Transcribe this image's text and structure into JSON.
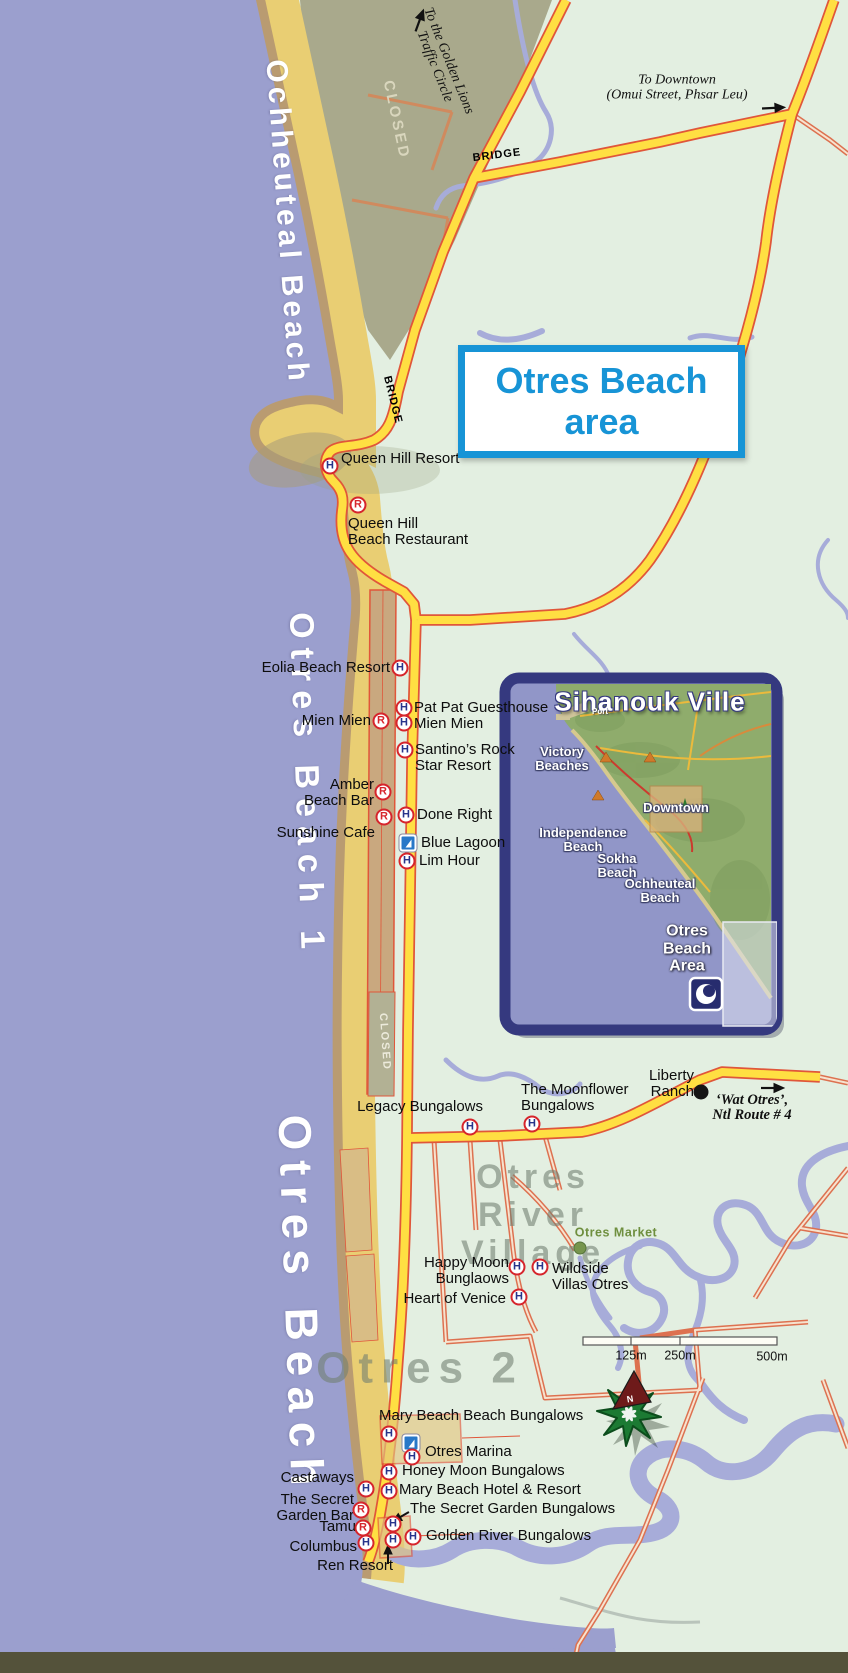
{
  "title_box": {
    "line1": "Otres Beach",
    "line2": "area"
  },
  "compass": {
    "letter": "N"
  },
  "colors": {
    "sea": "#9B9FCE",
    "land": "#E3EFE1",
    "sand": "#E9CE73",
    "wet_sand": "#AC8E70",
    "closed_area": "#A9A98C",
    "road_yellow": "#FFDF42",
    "road_casing": "#E0563A",
    "road_minor": "#DD7150",
    "river": "#A7ACD9",
    "title_blue": "#1794D6",
    "marker_red": "#D6252C",
    "marker_blue": "#27348B",
    "marker_sail_blue": "#2878C8",
    "inset_border": "#35397F",
    "inset_sea": "#9196C8",
    "inset_land": "#8FAC6C",
    "area_label_gray": "#707E70",
    "market_green": "#6F8F3F"
  },
  "map": {
    "labels": [
      {
        "name": "ochheuteal-beach-name",
        "text": "Ochheuteal Beach",
        "x": 287,
        "y": 222,
        "anchor": "middle",
        "cls": "beach-name sz30",
        "rot": 86
      },
      {
        "name": "golden-lions-direction",
        "text": "To the Golden Lions\nTraffic Circle",
        "x": 441,
        "y": 64,
        "anchor": "middle",
        "cls": "dir",
        "rot": 68
      },
      {
        "name": "downtown-direction",
        "text": "To Downtown\n(Omui Street, Phsar Leu)",
        "x": 677,
        "y": 88,
        "anchor": "middle",
        "cls": "dir ta-c"
      },
      {
        "name": "bridge-label-top",
        "text": "BRIDGE",
        "x": 497,
        "y": 156,
        "anchor": "middle",
        "cls": "road-label",
        "rot": -7
      },
      {
        "name": "closed-label-top",
        "text": "CLOSED",
        "x": 396,
        "y": 120,
        "anchor": "middle",
        "cls": "closed-label",
        "rot": 78
      },
      {
        "name": "bridge-label-mid",
        "text": "BRIDGE",
        "x": 392,
        "y": 400,
        "anchor": "middle",
        "cls": "road-label",
        "rot": 76
      },
      {
        "name": "queen-hill-resort-label",
        "text": "Queen Hill Resort",
        "x": 341,
        "y": 451,
        "anchor": "left",
        "cls": "poi"
      },
      {
        "name": "queen-hill-restaurant-label",
        "text": "Queen Hill\nBeach Restaurant",
        "x": 348,
        "y": 516,
        "anchor": "left",
        "cls": "poi"
      },
      {
        "name": "otres-beach-1-name",
        "text": "Otres Beach 1",
        "x": 306,
        "y": 785,
        "anchor": "middle",
        "cls": "beach-name sz34",
        "rot": 88
      },
      {
        "name": "eolia-beach-resort-label",
        "text": "Eolia Beach Resort",
        "x": 390,
        "y": 660,
        "anchor": "right",
        "cls": "poi"
      },
      {
        "name": "pat-pat-guesthouse-label",
        "text": "Pat Pat Guesthouse",
        "x": 414,
        "y": 700,
        "anchor": "left",
        "cls": "poi"
      },
      {
        "name": "mien-mien-label-left",
        "text": "Mien Mien",
        "x": 371,
        "y": 713,
        "anchor": "right",
        "cls": "poi"
      },
      {
        "name": "mien-mien-label-right",
        "text": "Mien Mien",
        "x": 414,
        "y": 716,
        "anchor": "left",
        "cls": "poi"
      },
      {
        "name": "santinos-rock-star-label",
        "text": "Santino’s Rock\nStar Resort",
        "x": 415,
        "y": 742,
        "anchor": "left",
        "cls": "poi"
      },
      {
        "name": "amber-beach-bar-label",
        "text": "Amber\nBeach Bar",
        "x": 374,
        "y": 777,
        "anchor": "right",
        "cls": "poi"
      },
      {
        "name": "done-right-label",
        "text": "Done Right",
        "x": 417,
        "y": 807,
        "anchor": "left",
        "cls": "poi"
      },
      {
        "name": "sunshine-cafe-label",
        "text": "Sunshine Cafe",
        "x": 375,
        "y": 825,
        "anchor": "right",
        "cls": "poi"
      },
      {
        "name": "blue-lagoon-label",
        "text": "Blue Lagoon",
        "x": 421,
        "y": 835,
        "anchor": "left",
        "cls": "poi"
      },
      {
        "name": "lim-hour-label",
        "text": "Lim Hour",
        "x": 419,
        "y": 853,
        "anchor": "left",
        "cls": "poi"
      },
      {
        "name": "legacy-bungalows-label",
        "text": "Legacy Bungalows",
        "x": 483,
        "y": 1099,
        "anchor": "right",
        "cls": "poi"
      },
      {
        "name": "moonflower-bungalows-label",
        "text": "The Moonflower\nBungalows",
        "x": 521,
        "y": 1082,
        "anchor": "left",
        "cls": "poi"
      },
      {
        "name": "liberty-ranch-label",
        "text": "Liberty\nRanch",
        "x": 694,
        "y": 1068,
        "anchor": "right",
        "cls": "poi"
      },
      {
        "name": "wat-otres-direction",
        "text": "‘Wat Otres’,\nNtl Route # 4",
        "x": 752,
        "y": 1108,
        "anchor": "middle",
        "cls": "dir dir-bold ta-c"
      },
      {
        "name": "closed-label-mid",
        "text": "CLOSED",
        "x": 384,
        "y": 1042,
        "anchor": "middle",
        "cls": "closed-label-sm",
        "rot": 86
      },
      {
        "name": "otres-beach-name",
        "text": "Otres Beach",
        "x": 301,
        "y": 1305,
        "anchor": "middle",
        "cls": "beach-name sz40",
        "rot": 88
      },
      {
        "name": "otres-river-village-label",
        "text": "Otres\nRiver\nVillage",
        "x": 533,
        "y": 1215,
        "anchor": "middle",
        "cls": "area-label ta-c"
      },
      {
        "name": "otres-market-label",
        "text": "Otres Market",
        "x": 616,
        "y": 1233,
        "anchor": "middle",
        "cls": "market-label"
      },
      {
        "name": "happy-moon-label",
        "text": "Happy Moon\nBunglaows",
        "x": 509,
        "y": 1255,
        "anchor": "right",
        "cls": "poi"
      },
      {
        "name": "wildside-villas-label",
        "text": "Wildside\nVillas Otres",
        "x": 552,
        "y": 1261,
        "anchor": "left",
        "cls": "poi"
      },
      {
        "name": "heart-of-venice-label",
        "text": "Heart of Venice",
        "x": 506,
        "y": 1291,
        "anchor": "right",
        "cls": "poi"
      },
      {
        "name": "scale-label-125",
        "text": "125m",
        "x": 631,
        "y": 1356,
        "anchor": "middle",
        "cls": "scale-label"
      },
      {
        "name": "scale-label-250",
        "text": "250m",
        "x": 680,
        "y": 1356,
        "anchor": "middle",
        "cls": "scale-label"
      },
      {
        "name": "scale-label-500",
        "text": "500m",
        "x": 772,
        "y": 1357,
        "anchor": "middle",
        "cls": "scale-label"
      },
      {
        "name": "otres-2-label",
        "text": "Otres 2",
        "x": 420,
        "y": 1368,
        "anchor": "middle",
        "cls": "area-label area-2"
      },
      {
        "name": "mary-beach-bungalows-label",
        "text": "Mary Beach Beach Bungalows",
        "x": 379,
        "y": 1408,
        "anchor": "left",
        "cls": "poi"
      },
      {
        "name": "otres-marina-label",
        "text": "Otres Marina",
        "x": 425,
        "y": 1444,
        "anchor": "left",
        "cls": "poi"
      },
      {
        "name": "castaways-label",
        "text": "Castaways",
        "x": 354,
        "y": 1470,
        "anchor": "right",
        "cls": "poi"
      },
      {
        "name": "honey-moon-label",
        "text": "Honey Moon Bungalows",
        "x": 402,
        "y": 1463,
        "anchor": "left",
        "cls": "poi"
      },
      {
        "name": "mary-beach-hotel-label",
        "text": "Mary Beach Hotel & Resort",
        "x": 399,
        "y": 1482,
        "anchor": "left",
        "cls": "poi"
      },
      {
        "name": "secret-garden-bar-label",
        "text": "The Secret\nGarden Bar",
        "x": 354,
        "y": 1492,
        "anchor": "right",
        "cls": "poi"
      },
      {
        "name": "secret-garden-bungalows-label",
        "text": "The Secret Garden Bungalows",
        "x": 410,
        "y": 1501,
        "anchor": "left",
        "cls": "poi"
      },
      {
        "name": "tamu-label",
        "text": "Tamu",
        "x": 356,
        "y": 1519,
        "anchor": "right",
        "cls": "poi"
      },
      {
        "name": "golden-river-label",
        "text": "Golden River Bungalows",
        "x": 426,
        "y": 1528,
        "anchor": "left",
        "cls": "poi"
      },
      {
        "name": "columbus-label",
        "text": "Columbus",
        "x": 357,
        "y": 1539,
        "anchor": "right",
        "cls": "poi"
      },
      {
        "name": "ren-resort-label",
        "text": "Ren Resort",
        "x": 393,
        "y": 1558,
        "anchor": "right",
        "cls": "poi"
      },
      {
        "name": "inset-title",
        "text": "Sihanouk Ville",
        "x": 650,
        "y": 702,
        "anchor": "middle",
        "cls": "inset-title"
      },
      {
        "name": "inset-port-label",
        "text": "Port",
        "x": 600,
        "y": 712,
        "anchor": "middle",
        "cls": "inset-tiny"
      },
      {
        "name": "inset-victory-beaches-label",
        "text": "Victory\nBeaches",
        "x": 562,
        "y": 759,
        "anchor": "middle",
        "cls": "inset-label ta-c"
      },
      {
        "name": "inset-downtown-label",
        "text": "Downtown",
        "x": 676,
        "y": 808,
        "anchor": "middle",
        "cls": "inset-label"
      },
      {
        "name": "inset-independence-label",
        "text": "Independence\nBeach",
        "x": 583,
        "y": 840,
        "anchor": "middle",
        "cls": "inset-label ta-c"
      },
      {
        "name": "inset-sokha-label",
        "text": "Sokha\nBeach",
        "x": 617,
        "y": 866,
        "anchor": "middle",
        "cls": "inset-label ta-c"
      },
      {
        "name": "inset-ochheuteal-label",
        "text": "Ochheuteal\nBeach",
        "x": 660,
        "y": 891,
        "anchor": "middle",
        "cls": "inset-label ta-c"
      },
      {
        "name": "inset-otres-area-label",
        "text": "Otres\nBeach\nArea",
        "x": 687,
        "y": 949,
        "anchor": "middle",
        "cls": "inset-area-label ta-c"
      }
    ],
    "markers": [
      {
        "name": "queen-hill-resort-marker",
        "type": "H",
        "x": 330,
        "y": 466
      },
      {
        "name": "queen-hill-restaurant-marker",
        "type": "R",
        "x": 358,
        "y": 505
      },
      {
        "name": "eolia-beach-resort-marker",
        "type": "H",
        "x": 400,
        "y": 668
      },
      {
        "name": "pat-pat-guesthouse-marker",
        "type": "H",
        "x": 404,
        "y": 708
      },
      {
        "name": "mien-mien-restaurant-marker",
        "type": "R",
        "x": 381,
        "y": 721
      },
      {
        "name": "mien-mien-hotel-marker",
        "type": "H",
        "x": 404,
        "y": 723
      },
      {
        "name": "santinos-rock-star-marker",
        "type": "H",
        "x": 405,
        "y": 750
      },
      {
        "name": "amber-beach-bar-marker",
        "type": "R",
        "x": 383,
        "y": 792
      },
      {
        "name": "sunshine-cafe-marker",
        "type": "R",
        "x": 384,
        "y": 817
      },
      {
        "name": "done-right-marker",
        "type": "H",
        "x": 406,
        "y": 815
      },
      {
        "name": "blue-lagoon-marker",
        "type": "sail",
        "x": 408,
        "y": 843
      },
      {
        "name": "lim-hour-marker",
        "type": "H",
        "x": 407,
        "y": 861
      },
      {
        "name": "legacy-bungalows-marker",
        "type": "H",
        "x": 470,
        "y": 1127
      },
      {
        "name": "moonflower-bungalows-marker",
        "type": "H",
        "x": 532,
        "y": 1124
      },
      {
        "name": "liberty-ranch-marker",
        "type": "dot",
        "x": 701,
        "y": 1092
      },
      {
        "name": "otres-market-marker",
        "type": "dotg",
        "x": 580,
        "y": 1248
      },
      {
        "name": "happy-moon-marker",
        "type": "H",
        "x": 517,
        "y": 1267
      },
      {
        "name": "wildside-villas-marker",
        "type": "H",
        "x": 540,
        "y": 1267
      },
      {
        "name": "heart-of-venice-marker",
        "type": "H",
        "x": 519,
        "y": 1297
      },
      {
        "name": "mary-beach-bungalows-marker",
        "type": "H",
        "x": 389,
        "y": 1434
      },
      {
        "name": "otres-marina-sail-marker",
        "type": "sail",
        "x": 411,
        "y": 1443
      },
      {
        "name": "otres-marina-marker",
        "type": "H",
        "x": 412,
        "y": 1457
      },
      {
        "name": "honey-moon-marker",
        "type": "H",
        "x": 389,
        "y": 1472
      },
      {
        "name": "castaways-marker",
        "type": "H",
        "x": 366,
        "y": 1489
      },
      {
        "name": "mary-beach-hotel-marker",
        "type": "H",
        "x": 389,
        "y": 1491
      },
      {
        "name": "secret-garden-bar-marker",
        "type": "R",
        "x": 361,
        "y": 1510
      },
      {
        "name": "secret-garden-bungalows-marker",
        "type": "H",
        "x": 393,
        "y": 1524
      },
      {
        "name": "tamu-marker",
        "type": "R",
        "x": 363,
        "y": 1528
      },
      {
        "name": "golden-river-marker",
        "type": "H",
        "x": 413,
        "y": 1537
      },
      {
        "name": "ren-resort-marker",
        "type": "H",
        "x": 393,
        "y": 1540
      },
      {
        "name": "columbus-marker",
        "type": "H",
        "x": 366,
        "y": 1543
      }
    ]
  }
}
